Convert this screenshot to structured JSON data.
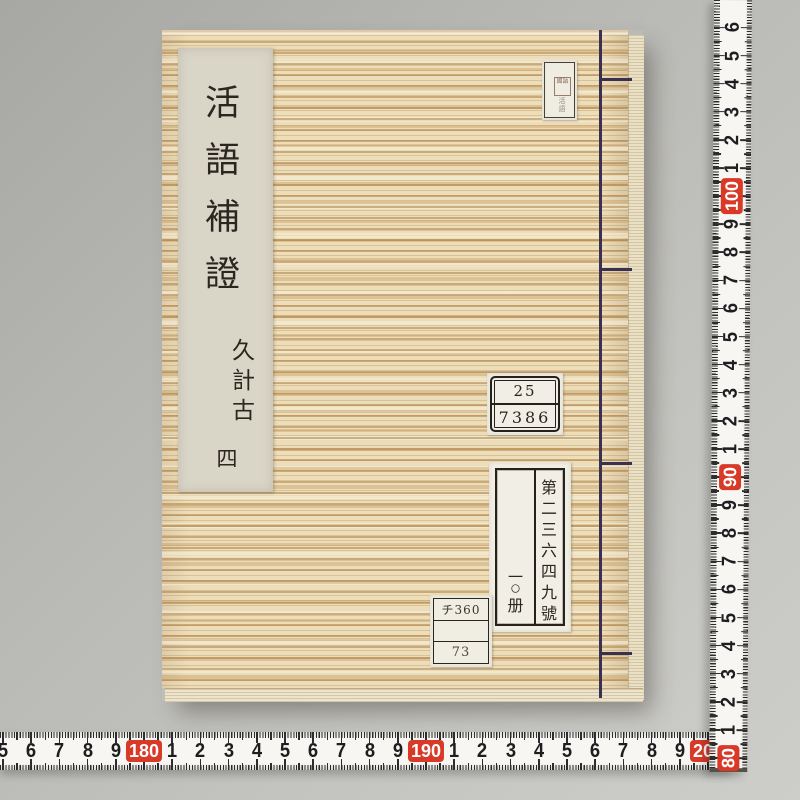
{
  "book": {
    "title_slip": {
      "title": "活語補證",
      "reading": "久計古",
      "volume": "四"
    },
    "seal_label": {
      "seal_text": "國語",
      "sub_text": "活語"
    },
    "call_number_label": {
      "top": "25",
      "bottom": "7386"
    },
    "accession_label": {
      "number_column": "第二三六四九號",
      "count_top": "一",
      "count_circle": "〇",
      "count_bottom": "册"
    },
    "shelf_label": {
      "row1": "チ360",
      "row2": "",
      "row3": "73"
    }
  },
  "rulers": {
    "unit": "cm",
    "highlight_color": "#d93a28",
    "vertical": {
      "tick_labels": [
        "6",
        "5",
        "4",
        "3",
        "2",
        "1",
        "100",
        "9",
        "8",
        "7",
        "6",
        "5",
        "4",
        "3",
        "2",
        "1",
        "90",
        "9",
        "8",
        "7",
        "6",
        "5",
        "4",
        "3",
        "2",
        "1",
        "80"
      ]
    },
    "horizontal": {
      "tick_labels": [
        "5",
        "6",
        "7",
        "8",
        "9",
        "180",
        "1",
        "2",
        "3",
        "4",
        "5",
        "6",
        "7",
        "8",
        "9",
        "190",
        "1",
        "2",
        "3",
        "4",
        "5",
        "6",
        "7",
        "8",
        "9",
        "200"
      ]
    }
  },
  "colors": {
    "background": "#bcbcb8",
    "cover_base": "#edddb8",
    "thread": "#3a3050",
    "label_paper": "#f1eee5",
    "ruler_tape": "#f7f6f3",
    "ruler_red": "#d93a28"
  }
}
